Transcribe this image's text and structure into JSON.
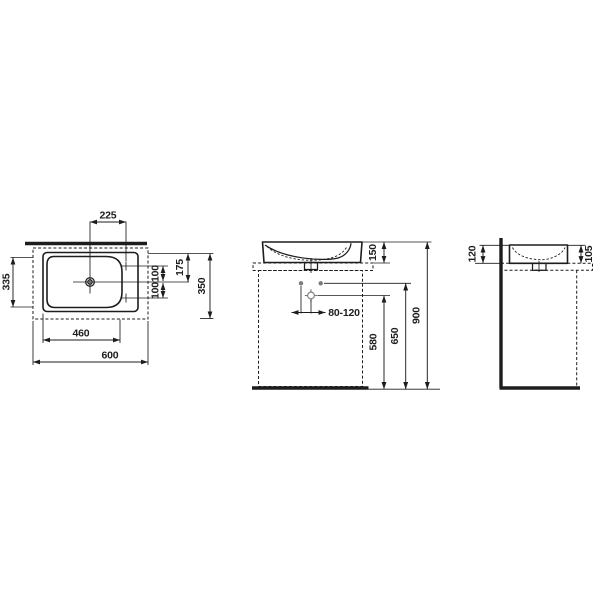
{
  "drawing": {
    "kind": "washbasin installation technical drawing",
    "views": {
      "top": {
        "dims": {
          "tap_offset": "225",
          "left_depth": "335",
          "spacing_upper": "100",
          "spacing_lower": "100",
          "half_depth": "175",
          "overall_depth": "350",
          "bowl_width": "460",
          "overall_width": "600"
        }
      },
      "front": {
        "dims": {
          "basin_height": "150",
          "outlet_range": "80-120",
          "outlet_height": "580",
          "fixing_height": "650",
          "rim_height": "900"
        }
      },
      "side": {
        "dims": {
          "rear_height": "120",
          "front_height": "105"
        }
      }
    },
    "colors": {
      "line": "#1d1d1d",
      "marker_gray": "#7b7b7b",
      "background": "#ffffff"
    }
  }
}
